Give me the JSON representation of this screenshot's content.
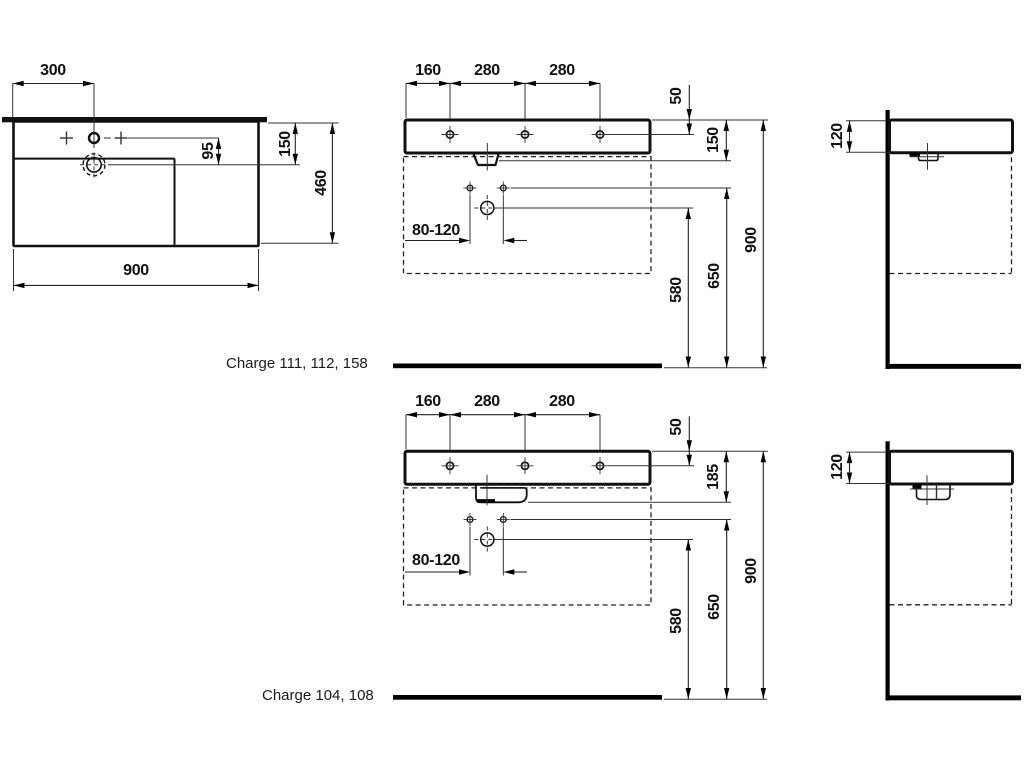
{
  "models": {
    "top": "Charge 111, 112, 158",
    "bottom": "Charge 104, 108"
  },
  "plan": {
    "faucet_offset": "300",
    "width": "900",
    "depth": "460",
    "faucet_to_drain": "95",
    "back_to_drain": "150"
  },
  "front_top": {
    "seg1": "160",
    "seg2": "280",
    "seg3": "280",
    "hole_inset": "50",
    "height": "150",
    "drain_height": "580",
    "fixing_height": "650",
    "rim_height": "900",
    "trap_range": "80-120"
  },
  "side_top": {
    "thickness": "120"
  },
  "front_bottom": {
    "seg1": "160",
    "seg2": "280",
    "seg3": "280",
    "hole_inset": "50",
    "height": "185",
    "drain_height": "580",
    "fixing_height": "650",
    "rim_height": "900",
    "trap_range": "80-120"
  },
  "side_bottom": {
    "thickness": "120"
  }
}
